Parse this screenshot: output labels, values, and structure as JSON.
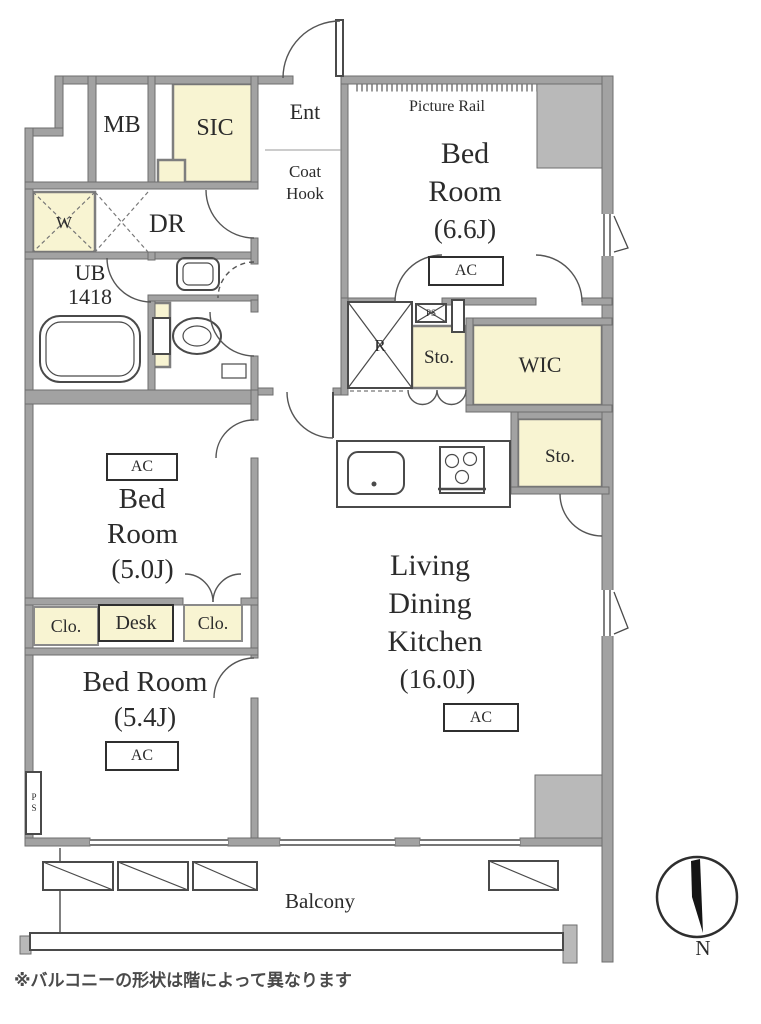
{
  "plan": {
    "footnote": "※バルコニーの形状は階によって異なります",
    "compass": {
      "north": "N"
    },
    "balcony": {
      "label": "Balcony"
    },
    "rooms": {
      "mb": "MB",
      "sic": "SIC",
      "ent": "Ent",
      "coat_hook_1": "Coat",
      "coat_hook_2": "Hook",
      "dr": "DR",
      "washer": "W",
      "ub_1": "UB",
      "ub_2": "1418",
      "fridge": "R",
      "ps_top": "PS",
      "ps_left": "PS",
      "wic": "WIC",
      "sto_mid": "Sto.",
      "sto_right": "Sto.",
      "clo_left": "Clo.",
      "desk": "Desk",
      "clo_right": "Clo.",
      "bed66": {
        "picture_rail": "Picture Rail",
        "l1": "Bed",
        "l2": "Room",
        "size": "(6.6J)",
        "ac": "AC"
      },
      "bed50": {
        "l1": "Bed",
        "l2": "Room",
        "size": "(5.0J)",
        "ac": "AC"
      },
      "bed54": {
        "l1": "Bed Room",
        "size": "(5.4J)",
        "ac": "AC"
      },
      "ldk": {
        "l1": "Living",
        "l2": "Dining",
        "l3": "Kitchen",
        "size": "(16.0J)",
        "ac": "AC"
      }
    },
    "colors": {
      "wall_gray": "#a2a2a2",
      "block_gray": "#b9b9b9",
      "closet_yellow": "#f8f4d2",
      "line_dark": "#4a4a4a"
    }
  }
}
